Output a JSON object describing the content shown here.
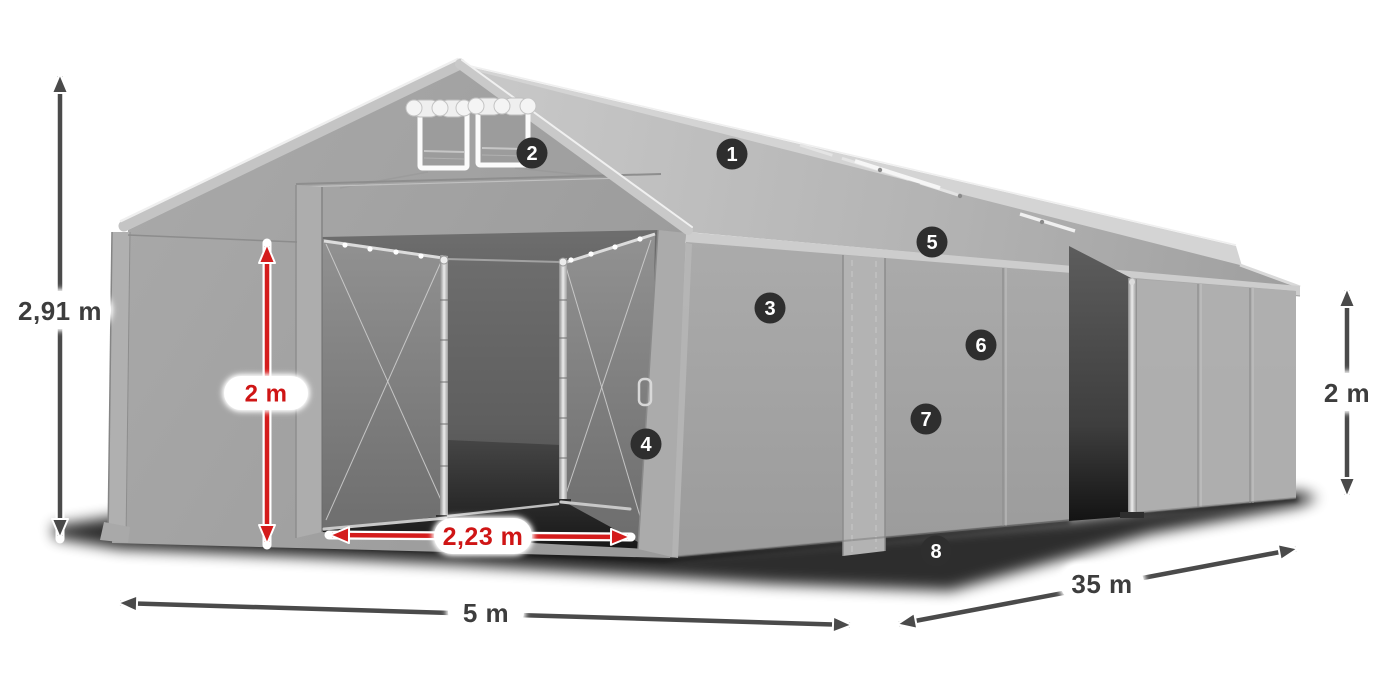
{
  "diagram": {
    "subject": "Gray PVC storage tent illustration with dimension arrows and numbered part callouts"
  },
  "dimensions": {
    "total_height": {
      "label": "2,91 m",
      "color": "#3d3d3d"
    },
    "entrance_height": {
      "label": "2 m",
      "color": "#cf1515"
    },
    "entrance_width": {
      "label": "2,23 m",
      "color": "#cf1515"
    },
    "front_width": {
      "label": "5 m",
      "color": "#3d3d3d"
    },
    "side_length": {
      "label": "35 m",
      "color": "#3d3d3d"
    },
    "side_wall_height": {
      "label": "2 m",
      "color": "#3d3d3d"
    }
  },
  "callouts": [
    {
      "number": "1"
    },
    {
      "number": "2"
    },
    {
      "number": "3"
    },
    {
      "number": "4"
    },
    {
      "number": "5"
    },
    {
      "number": "6"
    },
    {
      "number": "7"
    },
    {
      "number": "8"
    }
  ],
  "colors": {
    "arrow_gray": "#4a4a4a",
    "arrow_red": "#d41c1c",
    "badge_background": "#2e2e2e",
    "badge_text": "#ffffff",
    "label_pill": "#ffffff",
    "tent_canvas": "#a4a4a4"
  }
}
